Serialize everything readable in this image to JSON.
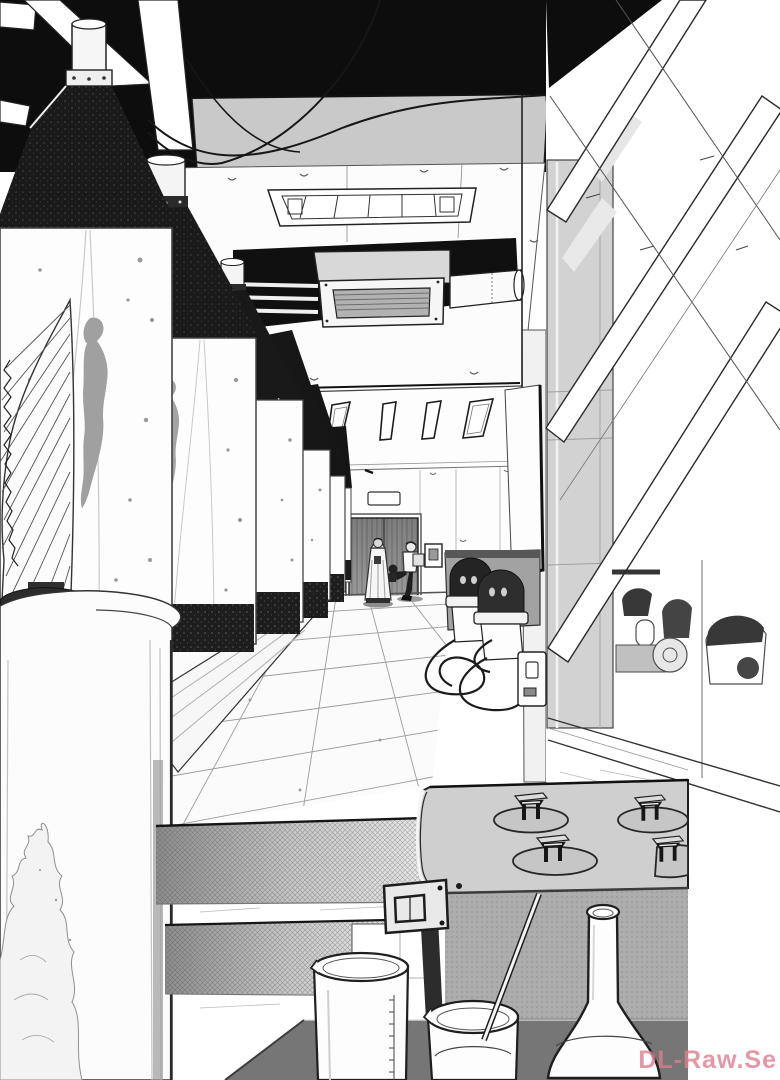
{
  "artwork": {
    "type": "manga-page-illustration",
    "style": "black-and-white screentone line art",
    "scene": "laboratory corridor with a row of large glass specimen tanks containing humanoid silhouettes, tiled floor leading to a dark double door, window truss wall on the right, lab bench equipment in the foreground",
    "objects": {
      "tanks": "six cylindrical specimen tanks with dark stippled caps, receding in perspective",
      "tank_contents": "gray floating humanoid silhouettes with bubbles",
      "ceiling": "recessed light fixture, air-conditioning vent with louvers, pipes, drooping cables",
      "back_wall": "four slanted clerestory windows, dark double door with nameplate, keypad panel, small stool",
      "figures": "robed standing figure, walking figure carrying a box, small creature",
      "right_side": "gray pillar, diagonal window truss beams, machines behind glass, wall outlet with cables, floor pumps",
      "foreground": "crosshatched steps, four-burner hotplate machine with clamps, graduated beaker, beaker with stirring rod, volumetric flask on dark table, corrugated shell apparatus, wisp of smoke"
    }
  },
  "watermark": {
    "text": "DL-Raw.Se",
    "color": "#dd7d8d"
  },
  "palette": {
    "paper": "#ffffff",
    "ink": "#1a1a1a",
    "void_black": "#0d0d0d",
    "fascia_gray": "#c9c9c9",
    "pillar_gray": "#d2d2d2",
    "machine_top": "#cfcfcf",
    "machine_front": "#acacac",
    "table_dark": "#767676",
    "silhouette_gray": "#a3a3a3",
    "door_gray": "#8e8e8e"
  }
}
